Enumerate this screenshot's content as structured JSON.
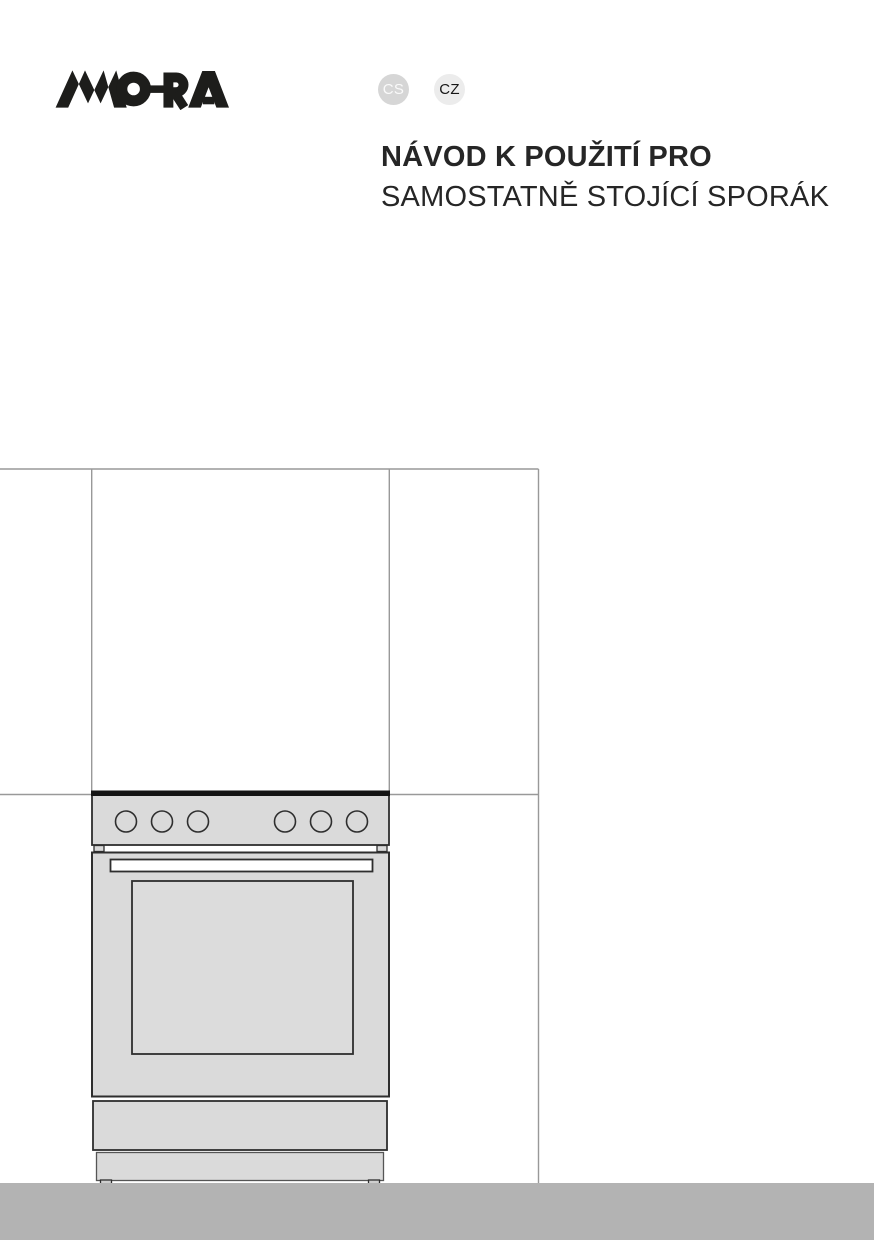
{
  "document": {
    "brand": {
      "logo_text": "MORA"
    },
    "header": {
      "language_badges": [
        {
          "code": "CS",
          "state": "muted"
        },
        {
          "code": "CZ",
          "state": "active"
        }
      ]
    },
    "title": {
      "line1": "NÁVOD K POUŽITÍ PRO",
      "line2": "SAMOSTATNĚ STOJÍCÍ SPORÁK"
    },
    "illustration": {
      "type": "line-drawing",
      "subject": "freestanding cooker standing between kitchen cabinets",
      "control_knobs": 6
    },
    "colors": {
      "logo": "#1d1d1b",
      "title_text": "#262626",
      "badge_cs_bg": "#d6d6d6",
      "badge_cs_text": "#fafafa",
      "badge_cz_bg": "#ececec",
      "badge_cz_text": "#161616",
      "cabinet_line": "#999999",
      "stove_outline": "#2e2e2e",
      "stove_fill": "#dadada",
      "footer_bar": "#b3b3b3"
    }
  }
}
